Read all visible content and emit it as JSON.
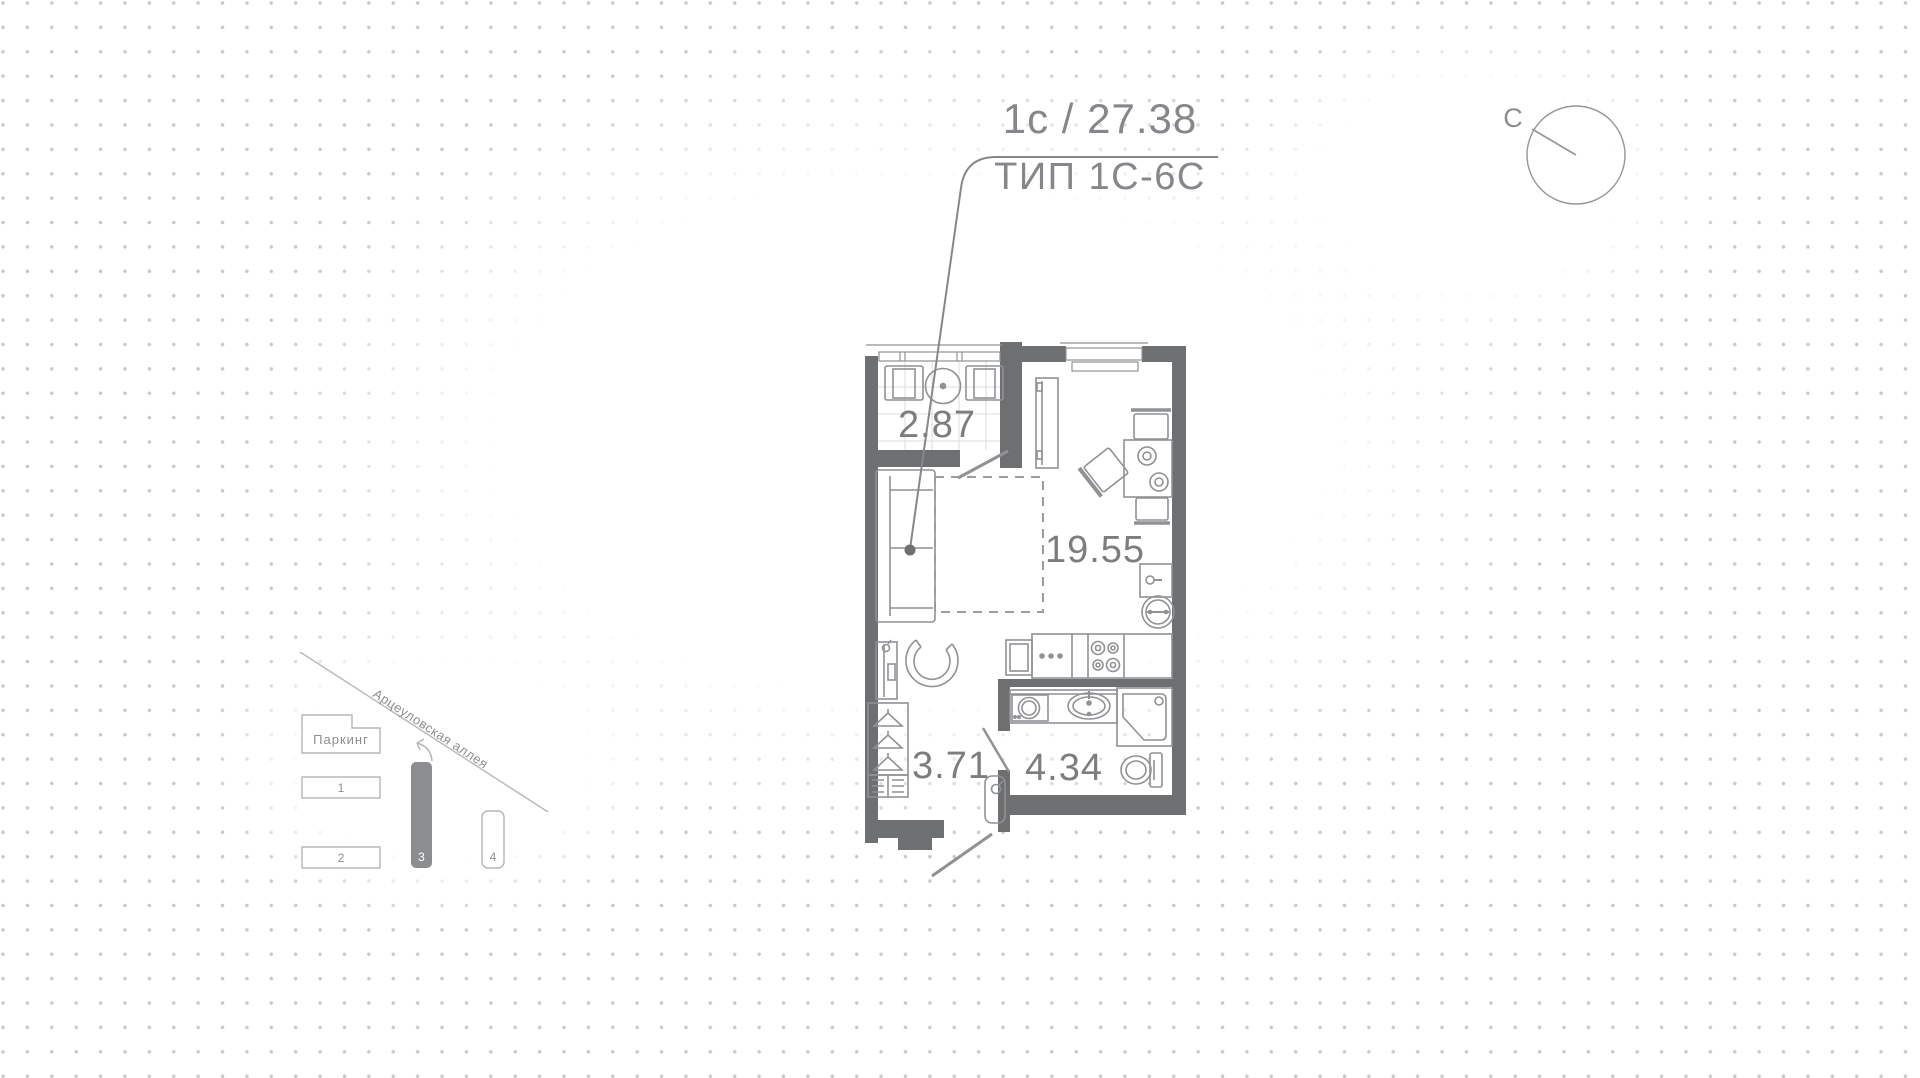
{
  "header": {
    "unit_code": "1с",
    "separator": "/",
    "total_area": "27.38",
    "type_label": "ТИП 1С-6С"
  },
  "compass": {
    "north_label": "С"
  },
  "floor_plan": {
    "rooms": [
      {
        "name": "balcony",
        "area": "2.87"
      },
      {
        "name": "living-kitchen",
        "area": "19.55"
      },
      {
        "name": "hallway",
        "area": "3.71"
      },
      {
        "name": "bathroom",
        "area": "4.34"
      }
    ]
  },
  "site_map": {
    "street_name": "Арцеуловская аллея",
    "parking_label": "Паркинг",
    "buildings": [
      {
        "label": "1",
        "highlighted": false
      },
      {
        "label": "2",
        "highlighted": false
      },
      {
        "label": "3",
        "highlighted": true
      },
      {
        "label": "4",
        "highlighted": false
      }
    ]
  },
  "colors": {
    "wall": "#6d6f70",
    "furniture_stroke": "#8f9194",
    "text_gray": "#7b7d7f",
    "title_gray": "#85878a",
    "dot_grid": "#c7c9cb",
    "map_stroke": "#b3b5b7",
    "map_highlight_fill": "#8b8d8f"
  }
}
